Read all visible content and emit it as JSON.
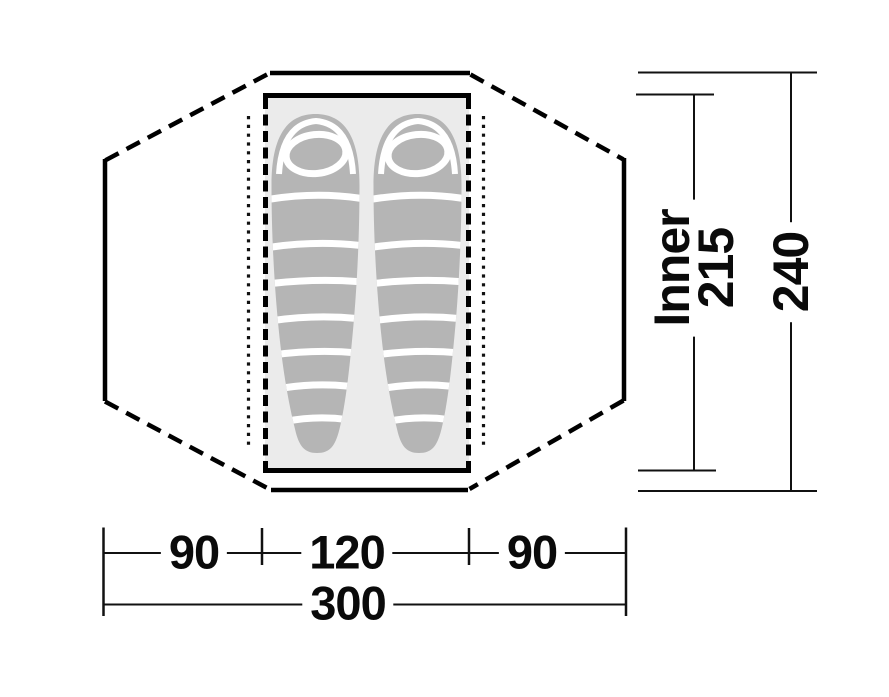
{
  "diagram": {
    "kind": "tent-floorplan-top-view",
    "dimensions": {
      "bottom_row": {
        "left": "90",
        "middle": "120",
        "right": "90"
      },
      "bottom_total": "300",
      "right_inner_label": "Inner",
      "right_inner_value": "215",
      "right_total_value": "240"
    },
    "colors": {
      "outline": "#000000",
      "floor_fill": "#ebebeb",
      "sleeping_bag_fill": "#b5b5b5",
      "stripe": "#ffffff",
      "background": "#ffffff"
    },
    "icons": {
      "left": "sleeping-bag-icon",
      "right": "sleeping-bag-icon"
    }
  }
}
